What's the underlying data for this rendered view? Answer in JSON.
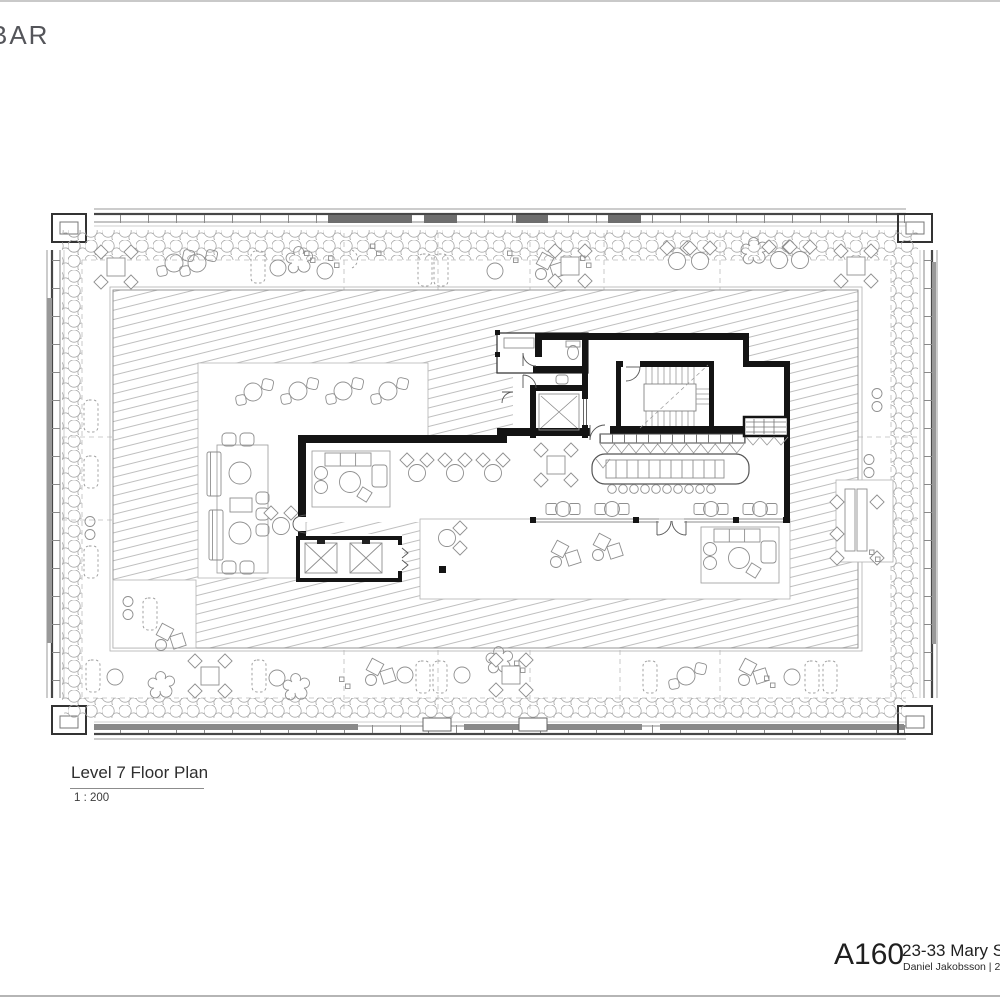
{
  "page": {
    "background": "#ffffff",
    "top_rule_color": "#c9c9c9",
    "bottom_rule_color": "#b5b5b5"
  },
  "logo": {
    "text": "BAR"
  },
  "drawing_title": {
    "title": "Level 7 Floor Plan",
    "scale": "1 : 200"
  },
  "title_block": {
    "sheet_number": "A160",
    "project": "23-33 Mary Stre",
    "credit": "Daniel Jakobsson | 28/0"
  },
  "plan_colors": {
    "wall": "#141414",
    "thin_wall": "#3a3a3a",
    "glass": "#8c8c8c",
    "hatch_line": "#949494",
    "furniture": "#8f8f8f",
    "planting": "#a6a6a6",
    "frame": "#444444"
  },
  "plan_icons": {
    "elevator": "elevator-cross-icon",
    "stair": "stair-treads-icon",
    "wc": "toilet-icon",
    "bar": "bar-counter-icon",
    "planting": "shrub-band-icon"
  }
}
